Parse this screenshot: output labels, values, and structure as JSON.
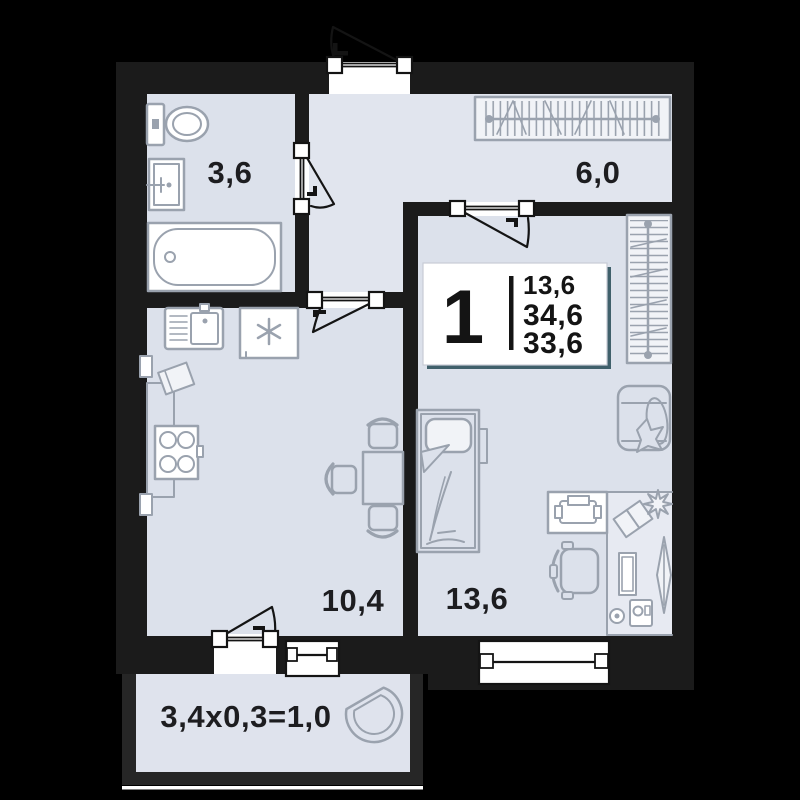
{
  "floorplan": {
    "unit_card": {
      "room_count": "1",
      "area_values": [
        "13,6",
        "34,6",
        "33,6"
      ]
    },
    "rooms": {
      "bathroom": {
        "area_label": "3,6"
      },
      "hallway": {
        "area_label": "6,0"
      },
      "kitchen_living": {
        "area_label": "10,4"
      },
      "bedroom": {
        "area_label": "13,6"
      },
      "balcony": {
        "area_label": "3,4х0,3=1,0"
      }
    },
    "colors": {
      "bg": "#000000",
      "wall": "#1b1b1b",
      "wall2": "#262626",
      "floor": "#dce1eb",
      "floor2": "#e1e5ee",
      "floor3": "#dfe3ed",
      "furn": "#9aa2ae",
      "ink": "#141414",
      "label": "#1d1d20",
      "shadow": "#40606b",
      "wfill": "#f1f3f7",
      "dfill": "#e7eaf2",
      "bborder": "#c7ccd6"
    }
  }
}
